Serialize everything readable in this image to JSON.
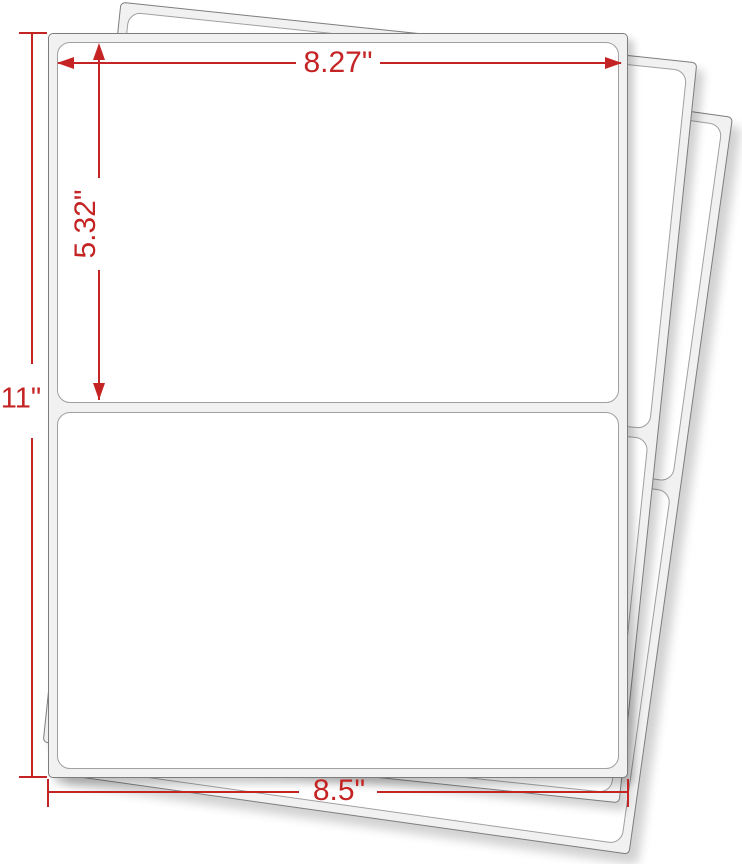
{
  "diagram": {
    "type": "label-sheet-dimension-diagram",
    "dimensions": {
      "label_width": "8.27\"",
      "label_height": "5.32\"",
      "sheet_height": "11\"",
      "sheet_width": "8.5\""
    },
    "sheets": {
      "count": 3,
      "labels_per_sheet": 2
    },
    "colors": {
      "dimension_accent": "#c42424",
      "sheet_fill": "#f1f1f1",
      "label_fill": "#ffffff",
      "sheet_border": "#7d7d7d",
      "label_border": "#a0a0a0",
      "background": "#ffffff"
    }
  }
}
